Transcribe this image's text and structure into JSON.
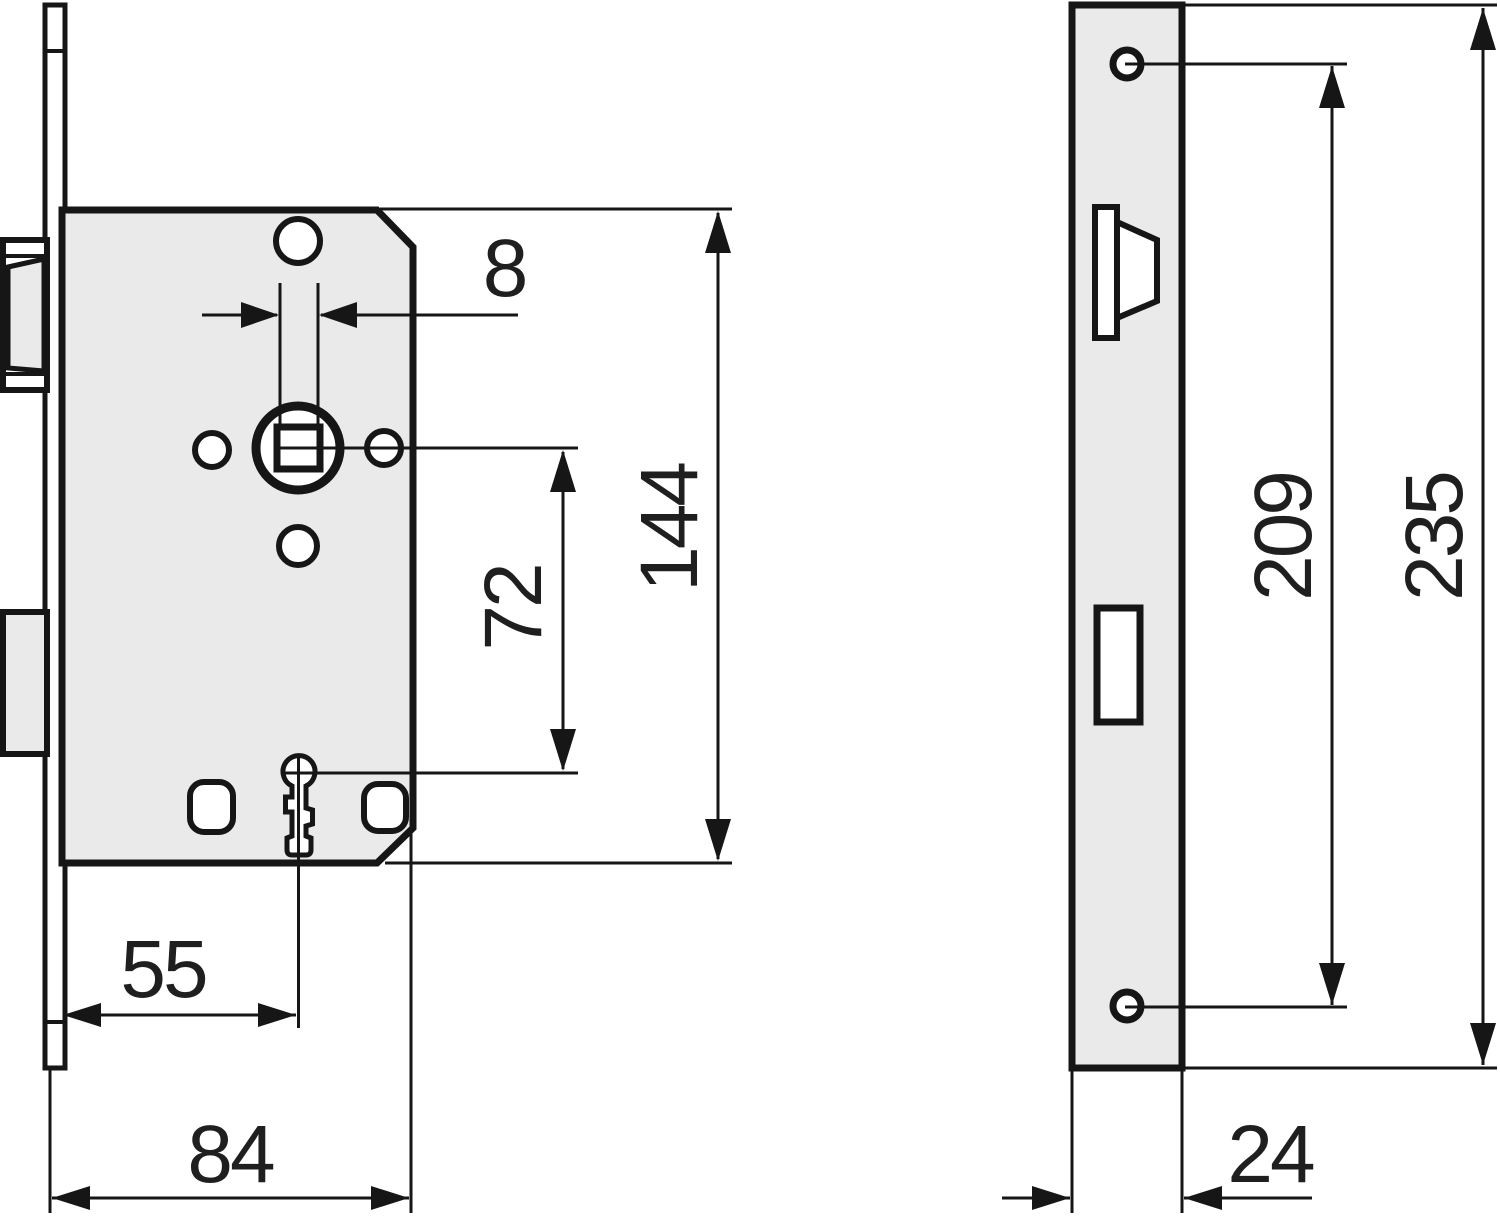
{
  "diagram": {
    "front_view": {
      "dim_square_follower": "8",
      "dim_case_height": "144",
      "dim_spindle_to_key": "72",
      "dim_backset": "55",
      "dim_case_depth": "84"
    },
    "faceplate_view": {
      "dim_screw_spacing": "209",
      "dim_faceplate_height": "235",
      "dim_faceplate_width": "24"
    },
    "colors": {
      "line": "#161616",
      "panel_fill": "#eaeaea",
      "background": "#ffffff"
    }
  }
}
